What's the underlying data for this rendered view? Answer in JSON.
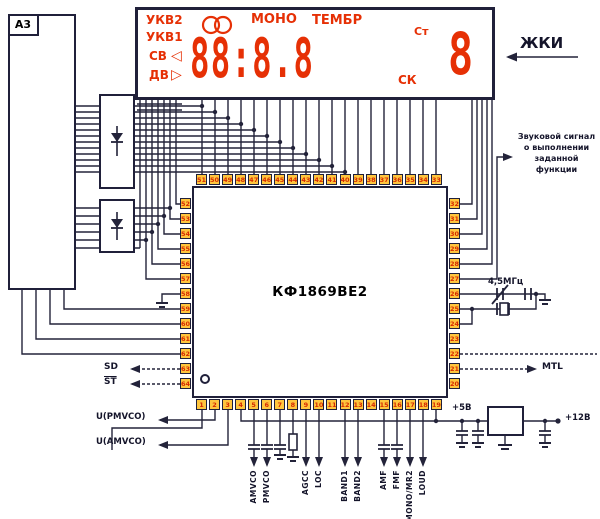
{
  "module_label": "А3",
  "display": {
    "band_labels": [
      "УКВ2",
      "УКВ1",
      "СВ",
      "ДВ"
    ],
    "mono": "МОНО",
    "tembr": "ТЕМБР",
    "st_indicator": "Ст",
    "sk_indicator": "СК",
    "digits": "88:8.8",
    "digit_right": "8",
    "tri_left": "◁",
    "tri_right": "▷",
    "accent_color": "#e63005"
  },
  "lcd_label": "ЖКИ",
  "ic": {
    "name": "КФ1869ВЕ2",
    "top_pins": [
      "51",
      "50",
      "49",
      "48",
      "47",
      "46",
      "45",
      "44",
      "43",
      "42",
      "41",
      "40",
      "39",
      "38",
      "37",
      "36",
      "35",
      "34",
      "33"
    ],
    "left_pins": [
      "52",
      "53",
      "54",
      "55",
      "56",
      "57",
      "58",
      "59",
      "60",
      "61",
      "62",
      "63",
      "64"
    ],
    "bottom_pins": [
      "1",
      "2",
      "3",
      "4",
      "5",
      "6",
      "7",
      "8",
      "9",
      "10",
      "11",
      "12",
      "13",
      "14",
      "15",
      "16",
      "17",
      "18",
      "19"
    ],
    "right_pins": [
      "32",
      "31",
      "30",
      "29",
      "28",
      "27",
      "26",
      "25",
      "24",
      "23",
      "22",
      "21",
      "20"
    ]
  },
  "annotations": {
    "sound_signal_lines": [
      "Звуковой сигнал",
      "о выполнении",
      "заданной функции"
    ],
    "crystal": "4,5МГц",
    "mtl": "MTL",
    "sd": "SD",
    "st": "ST",
    "u_pmvco": "U(PMVCO)",
    "u_amvco": "U(AMVCO)",
    "plus5": "+5В",
    "plus12": "+12В",
    "bottom_signals": [
      "AMVCO",
      "PMVCO",
      "AGCC",
      "LOC",
      "BAND1",
      "BAND2",
      "AMF",
      "FMF",
      "MONO/MR2",
      "LOUD"
    ]
  }
}
